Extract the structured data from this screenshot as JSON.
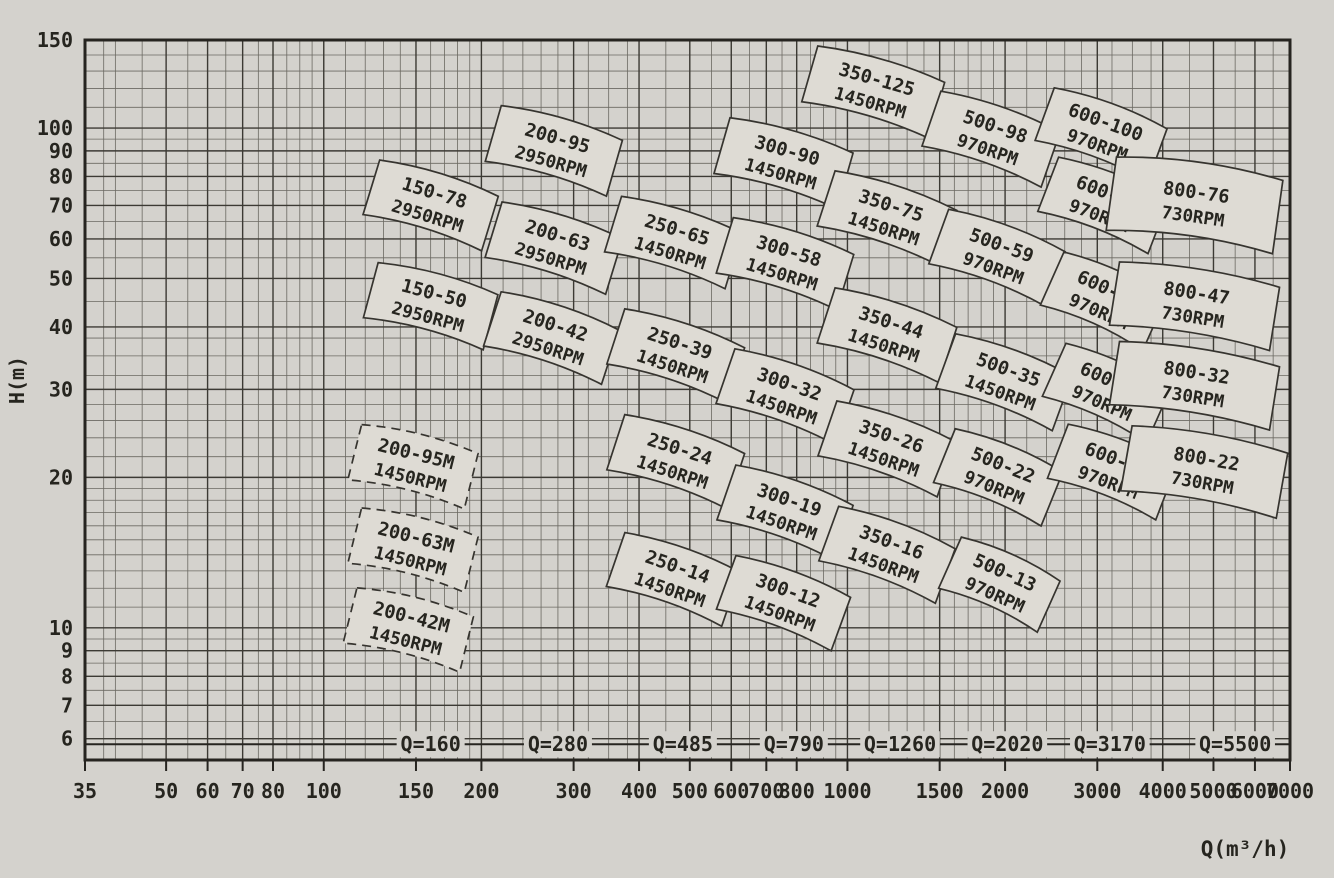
{
  "chart_data": {
    "type": "scatter",
    "subtype": "pump-selection-range-chart",
    "title": "",
    "xlabel": "Q(m³/h)",
    "ylabel": "H(m)",
    "x_scale": "log",
    "y_scale": "log",
    "xlim": [
      35,
      7000
    ],
    "ylim": [
      5.44,
      150
    ],
    "grid": true,
    "x_ticks": [
      35,
      50,
      60,
      70,
      80,
      100,
      150,
      200,
      300,
      400,
      500,
      600,
      700,
      800,
      1000,
      1500,
      2000,
      3000,
      4000,
      5000,
      6000,
      7000
    ],
    "y_ticks": [
      150,
      100,
      90,
      80,
      70,
      60,
      50,
      40,
      30,
      20,
      10,
      9,
      8,
      7,
      6
    ],
    "colors": {
      "paper": "#d4d2cd",
      "grid_minor": "#6b6962",
      "grid_major": "#3c3a34",
      "frame": "#262420",
      "box_fill": "#dedbd4",
      "box_stroke": "#36342f",
      "text": "#26251f"
    },
    "q_line": {
      "H": 5.85,
      "labels": [
        {
          "text": "Q=160",
          "Q": 160
        },
        {
          "text": "Q=280",
          "Q": 280
        },
        {
          "text": "Q=485",
          "Q": 485
        },
        {
          "text": "Q=790",
          "Q": 790
        },
        {
          "text": "Q=1260",
          "Q": 1260
        },
        {
          "text": "Q=2020",
          "Q": 2020
        },
        {
          "text": "Q=3170",
          "Q": 3170
        },
        {
          "text": "Q=5500",
          "Q": 5500
        }
      ]
    },
    "pump_boxes": [
      {
        "model": "150-78",
        "rpm": "2950RPM",
        "Q": 160,
        "H": 70,
        "angle": 17,
        "w": 124,
        "h": 57
      },
      {
        "model": "150-50",
        "rpm": "2950RPM",
        "Q": 160,
        "H": 44,
        "angle": 15,
        "w": 124,
        "h": 57
      },
      {
        "model": "200-95",
        "rpm": "2950RPM",
        "Q": 275,
        "H": 90,
        "angle": 16,
        "w": 126,
        "h": 58
      },
      {
        "model": "200-63",
        "rpm": "2950RPM",
        "Q": 275,
        "H": 57.5,
        "angle": 17,
        "w": 126,
        "h": 58
      },
      {
        "model": "200-42",
        "rpm": "2950RPM",
        "Q": 272,
        "H": 38,
        "angle": 18,
        "w": 124,
        "h": 57
      },
      {
        "model": "250-65",
        "rpm": "1450RPM",
        "Q": 465,
        "H": 59,
        "angle": 17,
        "w": 126,
        "h": 58
      },
      {
        "model": "250-39",
        "rpm": "1450RPM",
        "Q": 470,
        "H": 35,
        "angle": 18,
        "w": 126,
        "h": 58
      },
      {
        "model": "250-24",
        "rpm": "1450RPM",
        "Q": 470,
        "H": 21.5,
        "angle": 18,
        "w": 126,
        "h": 58
      },
      {
        "model": "250-14",
        "rpm": "1450RPM",
        "Q": 465,
        "H": 12.5,
        "angle": 19,
        "w": 122,
        "h": 57
      },
      {
        "model": "300-90",
        "rpm": "1450RPM",
        "Q": 755,
        "H": 85,
        "angle": 16,
        "w": 128,
        "h": 58
      },
      {
        "model": "300-58",
        "rpm": "1450RPM",
        "Q": 760,
        "H": 53.5,
        "angle": 17,
        "w": 126,
        "h": 58
      },
      {
        "model": "300-32",
        "rpm": "1450RPM",
        "Q": 760,
        "H": 29,
        "angle": 19,
        "w": 126,
        "h": 58
      },
      {
        "model": "300-19",
        "rpm": "1450RPM",
        "Q": 760,
        "H": 17,
        "angle": 19,
        "w": 124,
        "h": 58
      },
      {
        "model": "300-12",
        "rpm": "1450RPM",
        "Q": 755,
        "H": 11.2,
        "angle": 20,
        "w": 122,
        "h": 57
      },
      {
        "model": "350-125",
        "rpm": "1450RPM",
        "Q": 1120,
        "H": 118,
        "angle": 16,
        "w": 132,
        "h": 58
      },
      {
        "model": "350-75",
        "rpm": "1450RPM",
        "Q": 1190,
        "H": 66,
        "angle": 18,
        "w": 128,
        "h": 58
      },
      {
        "model": "350-44",
        "rpm": "1450RPM",
        "Q": 1190,
        "H": 38.5,
        "angle": 18,
        "w": 128,
        "h": 58
      },
      {
        "model": "350-26",
        "rpm": "1450RPM",
        "Q": 1190,
        "H": 22.8,
        "angle": 19,
        "w": 126,
        "h": 58
      },
      {
        "model": "350-16",
        "rpm": "1450RPM",
        "Q": 1190,
        "H": 14,
        "angle": 20,
        "w": 124,
        "h": 58
      },
      {
        "model": "500-98",
        "rpm": "970RPM",
        "Q": 1880,
        "H": 95,
        "angle": 19,
        "w": 126,
        "h": 58
      },
      {
        "model": "500-59",
        "rpm": "970RPM",
        "Q": 1930,
        "H": 55,
        "angle": 20,
        "w": 124,
        "h": 58
      },
      {
        "model": "500-35",
        "rpm": "1450RPM",
        "Q": 1990,
        "H": 31,
        "angle": 20,
        "w": 124,
        "h": 58
      },
      {
        "model": "500-22",
        "rpm": "970RPM",
        "Q": 1940,
        "H": 20,
        "angle": 22,
        "w": 116,
        "h": 58
      },
      {
        "model": "500-13",
        "rpm": "970RPM",
        "Q": 1950,
        "H": 12.2,
        "angle": 24,
        "w": 108,
        "h": 56
      },
      {
        "model": "600-100",
        "rpm": "970RPM",
        "Q": 3050,
        "H": 97,
        "angle": 20,
        "w": 120,
        "h": 56
      },
      {
        "model": "600-75",
        "rpm": "970RPM",
        "Q": 3080,
        "H": 70,
        "angle": 21,
        "w": 118,
        "h": 58
      },
      {
        "model": "600-47",
        "rpm": "970RPM",
        "Q": 3080,
        "H": 45,
        "angle": 24,
        "w": 112,
        "h": 58
      },
      {
        "model": "600-32",
        "rpm": "970RPM",
        "Q": 3120,
        "H": 29.5,
        "angle": 24,
        "w": 114,
        "h": 58
      },
      {
        "model": "600-22",
        "rpm": "970RPM",
        "Q": 3200,
        "H": 20.5,
        "angle": 21,
        "w": 116,
        "h": 58
      },
      {
        "model": "800-76",
        "rpm": "730RPM",
        "Q": 4600,
        "H": 70,
        "angle": 8,
        "w": 168,
        "h": 74
      },
      {
        "model": "800-47",
        "rpm": "730RPM",
        "Q": 4600,
        "H": 44,
        "angle": 9,
        "w": 162,
        "h": 64
      },
      {
        "model": "800-32",
        "rpm": "730RPM",
        "Q": 4600,
        "H": 30.5,
        "angle": 9,
        "w": 162,
        "h": 64
      },
      {
        "model": "800-22",
        "rpm": "730RPM",
        "Q": 4800,
        "H": 20.5,
        "angle": 10,
        "w": 158,
        "h": 66
      },
      {
        "model": "200-95M",
        "rpm": "1450RPM",
        "Q": 148,
        "H": 21,
        "angle": 14,
        "w": 120,
        "h": 57,
        "dashed": true
      },
      {
        "model": "200-63M",
        "rpm": "1450RPM",
        "Q": 148,
        "H": 14.3,
        "angle": 14,
        "w": 120,
        "h": 57,
        "dashed": true
      },
      {
        "model": "200-42M",
        "rpm": "1450RPM",
        "Q": 145,
        "H": 9.9,
        "angle": 14,
        "w": 120,
        "h": 57,
        "dashed": true
      }
    ]
  }
}
